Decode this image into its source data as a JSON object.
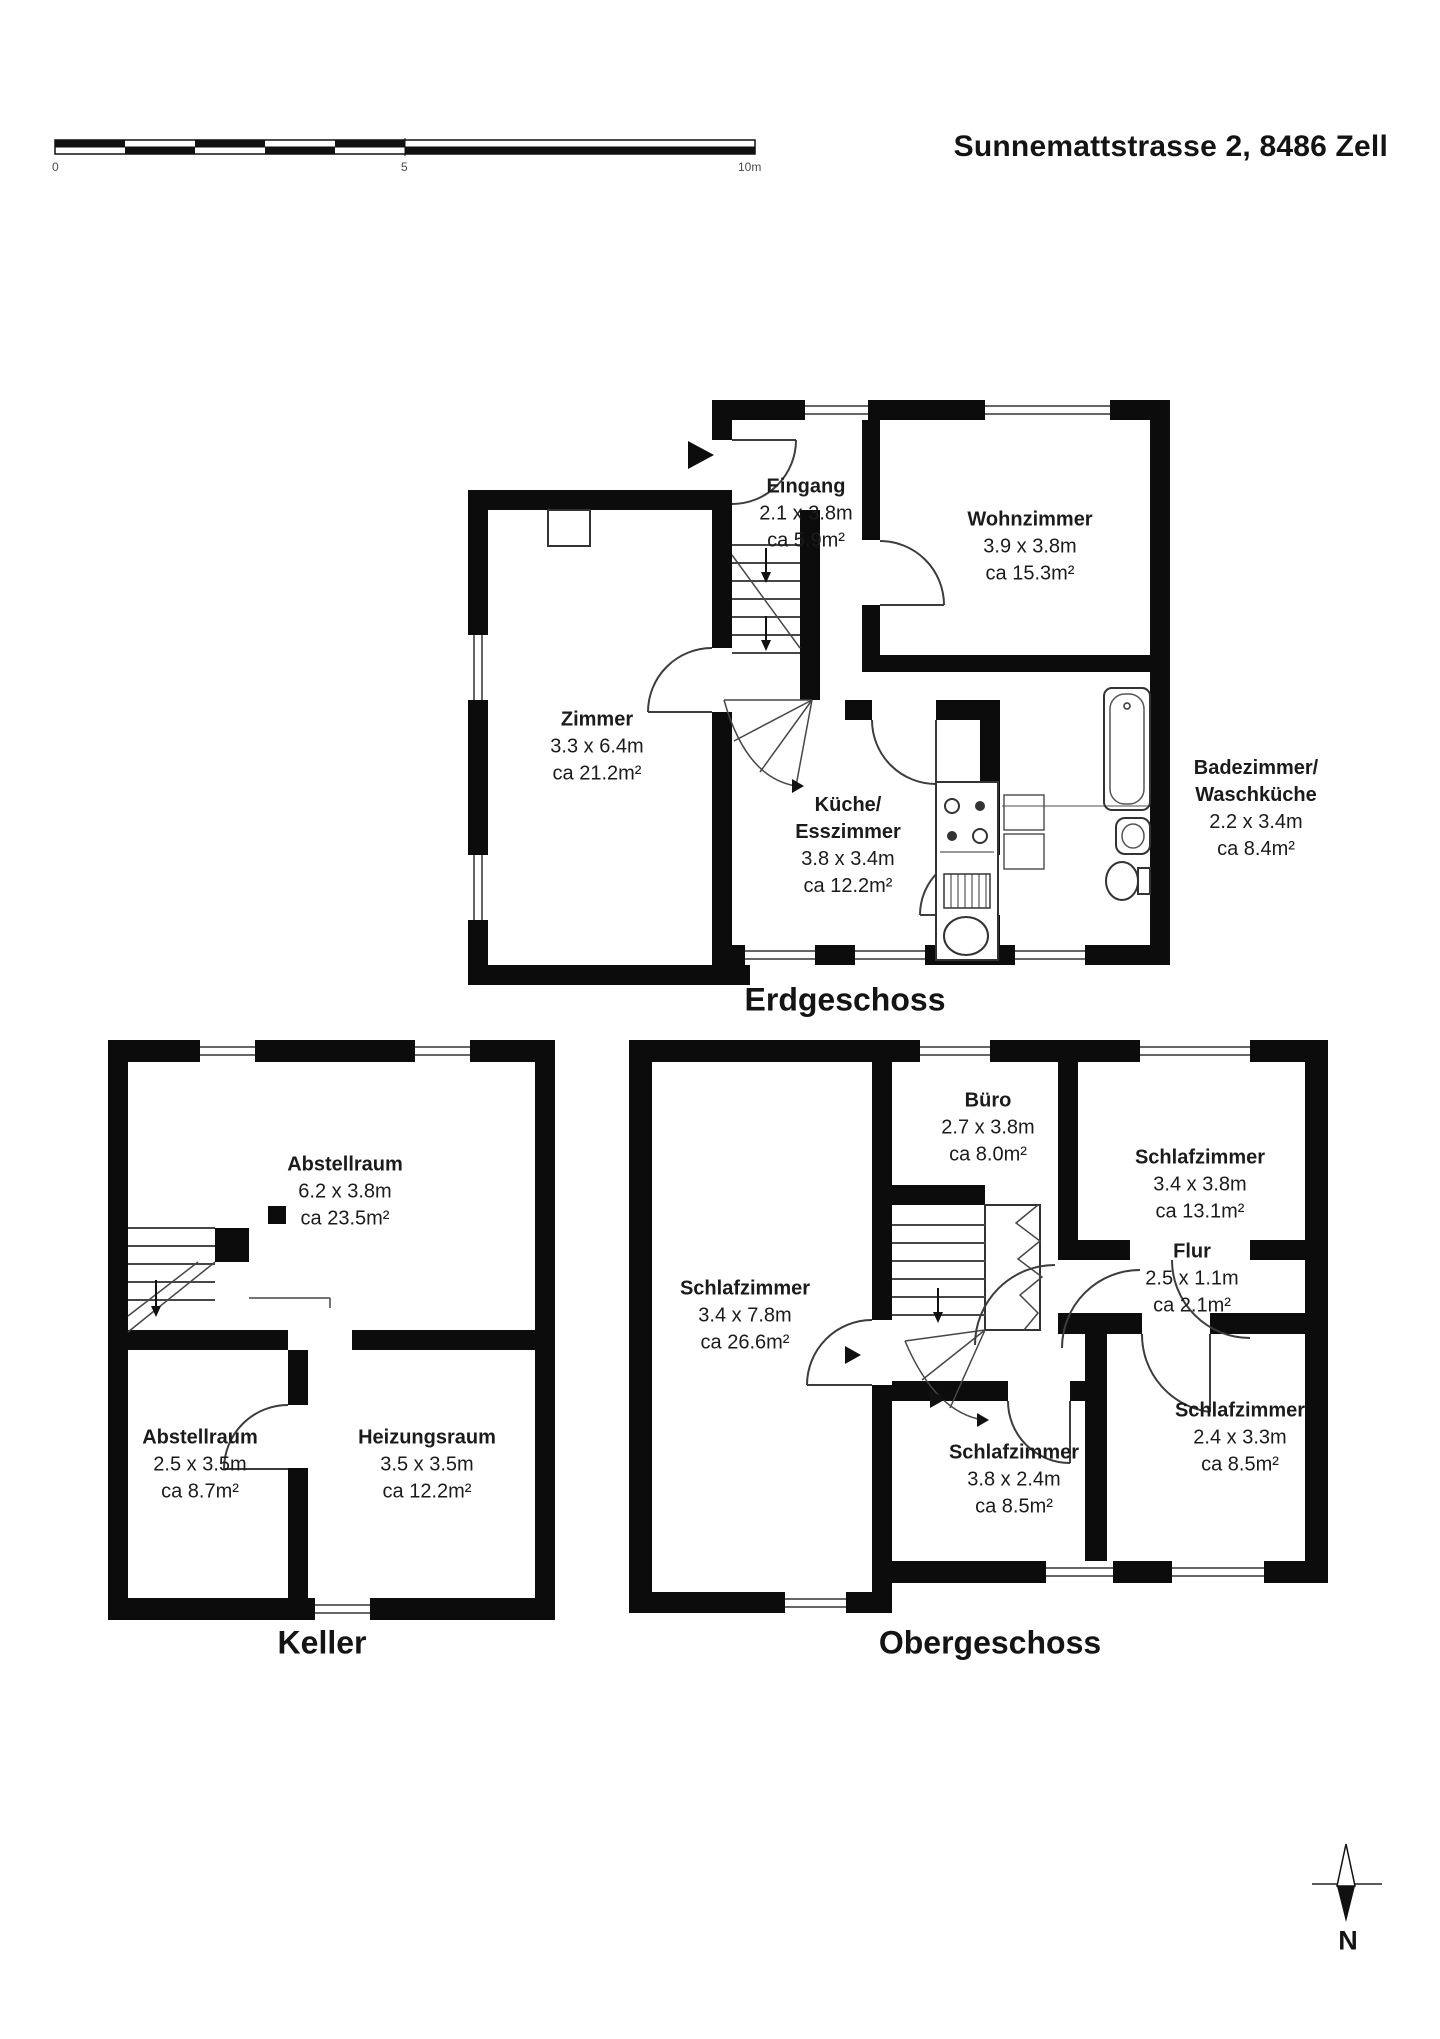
{
  "title": "Sunnemattstrasse 2, 8486 Zell",
  "scale_bar": {
    "zero": "0",
    "five": "5",
    "ten": "10m"
  },
  "compass": {
    "label": "N"
  },
  "floors": {
    "eg": {
      "title": "Erdgeschoss",
      "rooms": [
        {
          "name": "Eingang",
          "dims": "2.1 x 3.8m",
          "area": "ca 5.9m²"
        },
        {
          "name": "Wohnzimmer",
          "dims": "3.9 x 3.8m",
          "area": "ca 15.3m²"
        },
        {
          "name": "Zimmer",
          "dims": "3.3 x 6.4m",
          "area": "ca 21.2m²"
        },
        {
          "name": "Küche/\nEsszimmer",
          "dims": "3.8 x 3.4m",
          "area": "ca 12.2m²"
        },
        {
          "name": "Badezimmer/\nWaschküche",
          "dims": "2.2 x 3.4m",
          "area": "ca 8.4m²"
        }
      ]
    },
    "keller": {
      "title": "Keller",
      "rooms": [
        {
          "name": "Abstellraum",
          "dims": "6.2 x 3.8m",
          "area": "ca 23.5m²"
        },
        {
          "name": "Abstellraum",
          "dims": "2.5 x 3.5m",
          "area": "ca 8.7m²"
        },
        {
          "name": "Heizungsraum",
          "dims": "3.5 x 3.5m",
          "area": "ca 12.2m²"
        }
      ]
    },
    "og": {
      "title": "Obergeschoss",
      "rooms": [
        {
          "name": "Büro",
          "dims": "2.7 x 3.8m",
          "area": "ca 8.0m²"
        },
        {
          "name": "Schlafzimmer",
          "dims": "3.4 x 3.8m",
          "area": "ca 13.1m²"
        },
        {
          "name": "Schlafzimmer",
          "dims": "3.4 x 7.8m",
          "area": "ca 26.6m²"
        },
        {
          "name": "Flur",
          "dims": "2.5 x 1.1m",
          "area": "ca 2.1m²"
        },
        {
          "name": "Schlafzimmer",
          "dims": "3.8 x 2.4m",
          "area": "ca 8.5m²"
        },
        {
          "name": "Schlafzimmer",
          "dims": "2.4 x 3.3m",
          "area": "ca 8.5m²"
        }
      ]
    }
  }
}
